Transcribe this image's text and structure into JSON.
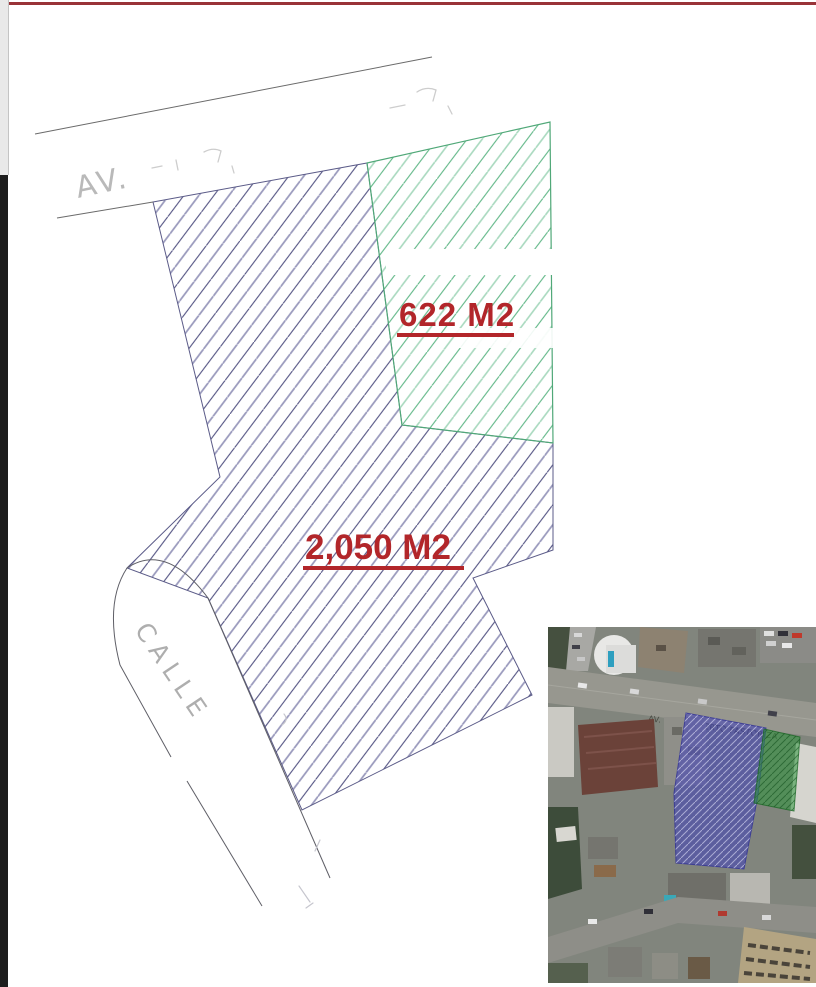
{
  "document": {
    "type": "land-survey-plot-plan",
    "background": "#ffffff",
    "accents": {
      "top_line_color": "#993338",
      "left_strip_top_color": "#e9e9e9",
      "left_strip_bottom_color": "#1d1d1d"
    }
  },
  "drawing": {
    "avenue_label": "AV.",
    "calle_label": "CALLE",
    "area_label_color": "#b2262a",
    "parcels": [
      {
        "id": "green-parcel",
        "area_label": "622 M2",
        "hatch_color": "#5cb584",
        "outline_color": "#50a878"
      },
      {
        "id": "blue-parcel",
        "area_label": "2,050 M2",
        "hatch_color": "#4f4f80",
        "outline_color": "#5b5b88"
      }
    ]
  },
  "photo": {
    "street_caption": "AV. ING. ROBERTO PASTORIZA",
    "overlays": [
      {
        "id": "blue-overlay",
        "color": "#3e3eb9"
      },
      {
        "id": "green-overlay",
        "color": "#2e8c32"
      }
    ]
  }
}
